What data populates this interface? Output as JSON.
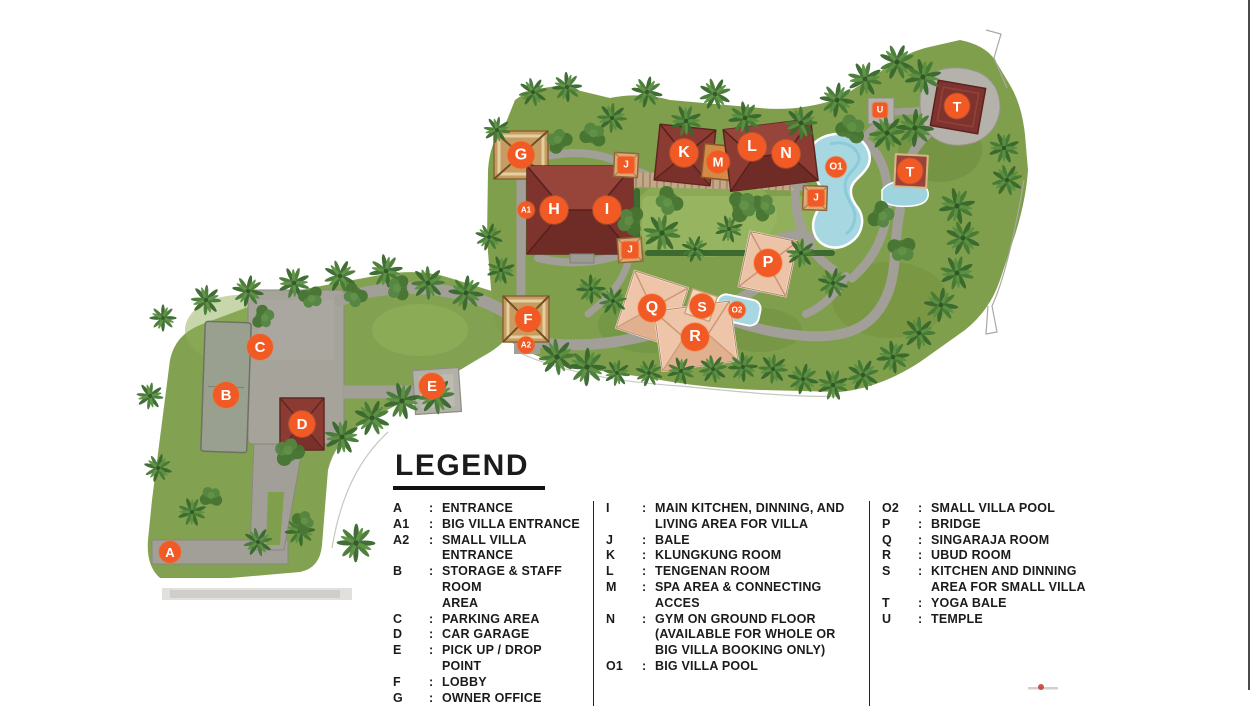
{
  "page": {
    "background": "#ffffff",
    "right_edge_border": "#4a4a4a"
  },
  "legend": {
    "title": "LEGEND",
    "separator": ":",
    "columns": [
      {
        "items": [
          {
            "key": "A",
            "desc": "ENTRANCE"
          },
          {
            "key": "A1",
            "desc": "BIG VILLA ENTRANCE"
          },
          {
            "key": "A2",
            "desc": "SMALL VILLA ENTRANCE"
          },
          {
            "key": "B",
            "desc": "STORAGE & STAFF ROOM\nAREA"
          },
          {
            "key": "C",
            "desc": "PARKING AREA"
          },
          {
            "key": "D",
            "desc": "CAR GARAGE"
          },
          {
            "key": "E",
            "desc": "PICK UP / DROP POINT"
          },
          {
            "key": "F",
            "desc": "LOBBY"
          },
          {
            "key": "G",
            "desc": "OWNER OFFICE"
          }
        ]
      },
      {
        "items": [
          {
            "key": "I",
            "desc": "MAIN KITCHEN, DINNING, AND\nLIVING AREA FOR VILLA"
          },
          {
            "key": "J",
            "desc": "BALE"
          },
          {
            "key": "K",
            "desc": "KLUNGKUNG ROOM"
          },
          {
            "key": "L",
            "desc": "TENGENAN ROOM"
          },
          {
            "key": "M",
            "desc": "SPA AREA & CONNECTING ACCES"
          },
          {
            "key": "N",
            "desc": "GYM ON GROUND FLOOR\n(AVAILABLE FOR WHOLE OR\nBIG VILLA BOOKING ONLY)"
          },
          {
            "key": "O1",
            "desc": "BIG VILLA POOL"
          }
        ]
      },
      {
        "items": [
          {
            "key": "O2",
            "desc": "SMALL VILLA POOL"
          },
          {
            "key": "P",
            "desc": "BRIDGE"
          },
          {
            "key": "Q",
            "desc": "SINGARAJA ROOM"
          },
          {
            "key": "R",
            "desc": "UBUD ROOM"
          },
          {
            "key": "S",
            "desc": "KITCHEN AND DINNING\nAREA FOR SMALL VILLA"
          },
          {
            "key": "T",
            "desc": "YOGA BALE"
          },
          {
            "key": "U",
            "desc": "TEMPLE"
          }
        ]
      }
    ]
  },
  "map": {
    "marker_color": "#f15a24",
    "markers": [
      {
        "id": "entrance",
        "label": "A",
        "x": 170,
        "y": 552,
        "shape": "circle",
        "size": 22
      },
      {
        "id": "big-villa-entrance",
        "label": "A1",
        "x": 526,
        "y": 210,
        "shape": "circle",
        "size": 17
      },
      {
        "id": "small-villa-entrance",
        "label": "A2",
        "x": 526,
        "y": 345,
        "shape": "circle",
        "size": 17
      },
      {
        "id": "storage-staff-room",
        "label": "B",
        "x": 226,
        "y": 395,
        "shape": "circle",
        "size": 26
      },
      {
        "id": "parking-area",
        "label": "C",
        "x": 260,
        "y": 347,
        "shape": "circle",
        "size": 26
      },
      {
        "id": "car-garage",
        "label": "D",
        "x": 302,
        "y": 424,
        "shape": "circle",
        "size": 26
      },
      {
        "id": "pickup-drop-point",
        "label": "E",
        "x": 432,
        "y": 386,
        "shape": "circle",
        "size": 26
      },
      {
        "id": "lobby",
        "label": "F",
        "x": 528,
        "y": 319,
        "shape": "circle",
        "size": 26
      },
      {
        "id": "owner-office",
        "label": "G",
        "x": 521,
        "y": 155,
        "shape": "circle",
        "size": 27
      },
      {
        "id": "main-villa-h",
        "label": "H",
        "x": 554,
        "y": 210,
        "shape": "circle",
        "size": 28
      },
      {
        "id": "main-kitchen-dining",
        "label": "I",
        "x": 607,
        "y": 210,
        "shape": "circle",
        "size": 28
      },
      {
        "id": "bale-1",
        "label": "J",
        "x": 626,
        "y": 165,
        "shape": "square",
        "size": 17
      },
      {
        "id": "bale-2",
        "label": "J",
        "x": 630,
        "y": 250,
        "shape": "square",
        "size": 17
      },
      {
        "id": "bale-3",
        "label": "J",
        "x": 816,
        "y": 198,
        "shape": "square",
        "size": 17
      },
      {
        "id": "klungkung-room",
        "label": "K",
        "x": 684,
        "y": 153,
        "shape": "circle",
        "size": 28
      },
      {
        "id": "tengenan-room",
        "label": "L",
        "x": 752,
        "y": 147,
        "shape": "circle",
        "size": 28
      },
      {
        "id": "spa-area",
        "label": "M",
        "x": 718,
        "y": 162,
        "shape": "circle",
        "size": 23
      },
      {
        "id": "gym",
        "label": "N",
        "x": 786,
        "y": 154,
        "shape": "circle",
        "size": 28
      },
      {
        "id": "big-villa-pool",
        "label": "O1",
        "x": 836,
        "y": 167,
        "shape": "circle",
        "size": 21
      },
      {
        "id": "small-villa-pool",
        "label": "O2",
        "x": 737,
        "y": 310,
        "shape": "circle",
        "size": 17
      },
      {
        "id": "bridge",
        "label": "P",
        "x": 768,
        "y": 263,
        "shape": "circle",
        "size": 28
      },
      {
        "id": "singaraja-room",
        "label": "Q",
        "x": 652,
        "y": 308,
        "shape": "circle",
        "size": 28
      },
      {
        "id": "ubud-room",
        "label": "R",
        "x": 695,
        "y": 337,
        "shape": "circle",
        "size": 28
      },
      {
        "id": "small-villa-kitchen",
        "label": "S",
        "x": 702,
        "y": 306,
        "shape": "circle",
        "size": 25
      },
      {
        "id": "yoga-bale-1",
        "label": "T",
        "x": 957,
        "y": 106,
        "shape": "circle",
        "size": 25
      },
      {
        "id": "yoga-bale-2",
        "label": "T",
        "x": 910,
        "y": 171,
        "shape": "circle",
        "size": 25
      },
      {
        "id": "temple",
        "label": "U",
        "x": 880,
        "y": 110,
        "shape": "square",
        "size": 15
      }
    ]
  }
}
